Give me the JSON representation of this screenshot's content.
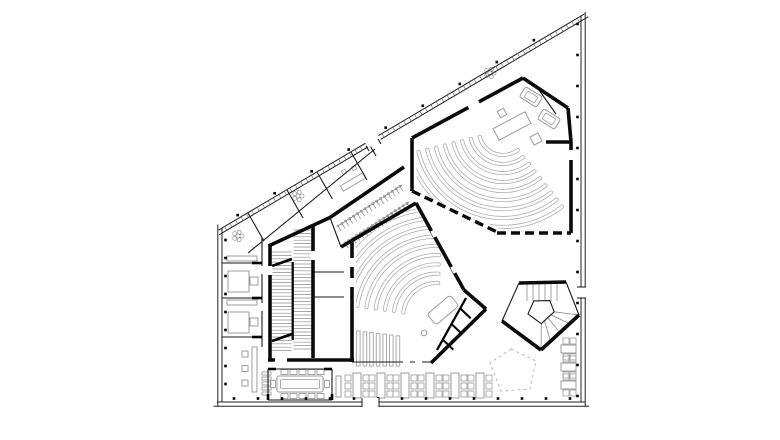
{
  "alt_text": "Black-and-white architectural floor plan: trapezoidal building with diagonal glazed facade, two fan-shaped auditoria with curved seating rows, central staircase block, pentagonal winding stair, offices, coat-hook rail and rows of reading tables.",
  "palette": {
    "ink": "#000000",
    "wall": "#0a0a0a",
    "thin": "#1a1a1a",
    "facade": "#222222",
    "tick": "#555555",
    "furniture": "#9b9b9b",
    "seating": "#aeaeae",
    "tread": "#8c8c8c",
    "hooks": "#8a8a8a",
    "dashed_outline": "#b9b9b9",
    "background": "#ffffff"
  },
  "plan": {
    "seating": {
      "large_hall_rows": 10,
      "small_hall_rows": 9,
      "corner_benches": 7
    },
    "furniture": {
      "study_tables_bottom": 6,
      "study_tables_right": 3,
      "conference_chairs_per_side": 5,
      "coat_hook_rows": 2,
      "office_desks": 2,
      "plants": 3,
      "shelf_slats": 5,
      "stools": 3
    },
    "stairs": {
      "main_flights": 2,
      "pentagon_top_treads": 6,
      "pentagon_fan_treads": 5
    },
    "elements": [
      "facade-shell",
      "auditorium-large",
      "auditorium-small",
      "stage-platforms",
      "cloakroom-hooks",
      "main-staircase",
      "pentagon-staircase",
      "dashed-roof-outline",
      "left-offices",
      "conference-room",
      "study-tables",
      "ancillary-rooms"
    ]
  }
}
